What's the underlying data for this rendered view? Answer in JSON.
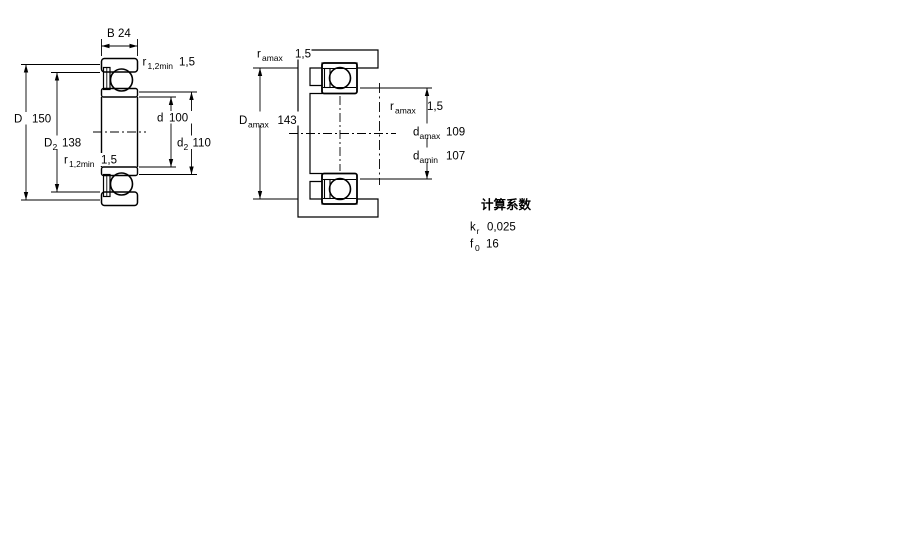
{
  "title": "bearing dimension drawing",
  "colors": {
    "line": "#000000",
    "background": "#ffffff",
    "section_fill_light": "#c6d7e8",
    "section_fill_dark": "#98b7d2"
  },
  "figure1": {
    "name": "bearing cross-section dimensions",
    "labels": {
      "B": {
        "sym": "B",
        "value": "24"
      },
      "r12_top": {
        "sym": "r",
        "sub": "1,2min",
        "value": "1,5"
      },
      "D": {
        "sym": "D",
        "value": "150"
      },
      "D2": {
        "sym": "D",
        "sub": "2",
        "value": "138"
      },
      "d": {
        "sym": "d",
        "value": "100"
      },
      "d2": {
        "sym": "d",
        "sub": "2",
        "value": "110"
      },
      "r12_mid": {
        "sym": "r",
        "sub": "1,2min",
        "value": "1,5"
      }
    }
  },
  "figure2": {
    "name": "abutment and fillet dimensions",
    "labels": {
      "ra_top": {
        "sym": "r",
        "sub": "amax",
        "value": "1,5"
      },
      "Da": {
        "sym": "D",
        "sub": "amax",
        "value": "143"
      },
      "ra_mid": {
        "sym": "r",
        "sub": "amax",
        "value": "1,5"
      },
      "da_max": {
        "sym": "d",
        "sub": "amax",
        "value": "109"
      },
      "da_min": {
        "sym": "d",
        "sub": "amin",
        "value": "107"
      }
    }
  },
  "factors": {
    "title": "计算系数",
    "kr": {
      "sym": "k",
      "sub": "r",
      "value": "0,025"
    },
    "f0": {
      "sym": "f",
      "sub": "0",
      "value": "16"
    }
  }
}
